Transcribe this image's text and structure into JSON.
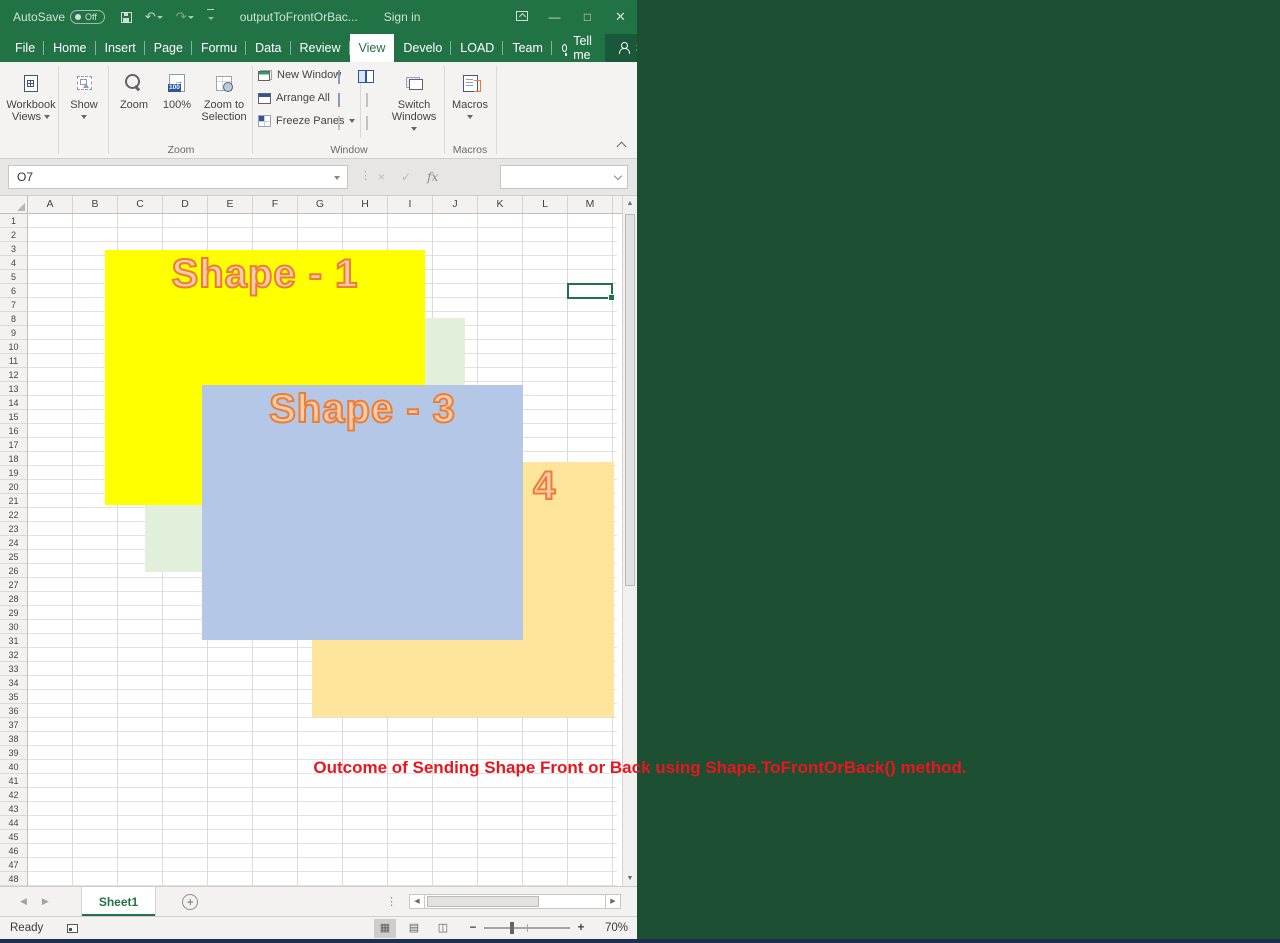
{
  "colors": {
    "titlebar_green": "#217346",
    "share_button_green": "#19583a",
    "window_divider_green": "#1d4f33",
    "bottom_strip_navy": "#1b2f52",
    "annotation_red": "#e8161e",
    "shape_text_fill": "#f8cbad",
    "shape_text_outline": "#ed7d31",
    "selection_green": "#217346"
  },
  "titlebar": {
    "autosave_label": "AutoSave",
    "autosave_state": "Off",
    "sign_in": "Sign in"
  },
  "ribbon_tabs": [
    {
      "label": "File"
    },
    {
      "label": "Home"
    },
    {
      "label": "Insert"
    },
    {
      "label": "Page L"
    },
    {
      "label": "Formu"
    },
    {
      "label": "Data"
    },
    {
      "label": "Review"
    },
    {
      "label": "View",
      "active": true
    },
    {
      "label": "Develo"
    },
    {
      "label": "LOAD T"
    },
    {
      "label": "Team"
    }
  ],
  "tellme_label": "Tell me",
  "share_label": "Share",
  "ribbon": {
    "workbook_views_line1": "Workbook",
    "workbook_views_line2": "Views",
    "show_label": "Show",
    "zoom_label": "Zoom",
    "hundred_label": "100%",
    "zoom_to_selection_line1": "Zoom to",
    "zoom_to_selection_line2": "Selection",
    "new_window_label": "New Window",
    "arrange_all_label": "Arrange All",
    "freeze_panes_label": "Freeze Panes",
    "switch_windows_line1": "Switch",
    "switch_windows_line2": "Windows",
    "macros_label": "Macros",
    "group_zoom": "Zoom",
    "group_window": "Window",
    "group_macros": "Macros"
  },
  "formula_bar": {
    "cancel": "×",
    "enter": "✓",
    "fx": "fx",
    "value": ""
  },
  "grid": {
    "columns": [
      "A",
      "B",
      "C",
      "D",
      "E",
      "F",
      "G",
      "H",
      "I",
      "J",
      "K",
      "L",
      "M"
    ],
    "rows": [
      "1",
      "2",
      "3",
      "4",
      "5",
      "6",
      "7",
      "8",
      "9",
      "10",
      "11",
      "12",
      "13",
      "14",
      "15",
      "16",
      "17",
      "18",
      "19",
      "20",
      "21",
      "22",
      "23",
      "24",
      "25",
      "26",
      "27",
      "28",
      "29",
      "30",
      "31",
      "32",
      "33",
      "34",
      "35",
      "36",
      "37",
      "38",
      "39",
      "40",
      "41",
      "42",
      "43",
      "44",
      "45",
      "46",
      "47",
      "48"
    ]
  },
  "windows": [
    {
      "title": "sampleToFrontOrBa...",
      "name_box": "M6",
      "is_active": true,
      "selected_col": "M",
      "selected_row": "6",
      "cursor_row": "37",
      "show_selection_cell": true,
      "shapes": [
        {
          "label": "Shape - 1",
          "fill": "#ffff00",
          "x": 77,
          "y": 36,
          "w": 320,
          "h": 255
        },
        {
          "label": "Shape - 2",
          "fill": "#e2efda",
          "x": 117,
          "y": 104,
          "w": 320,
          "h": 254
        },
        {
          "label": "Shape - 3",
          "fill": "#b4c7e7",
          "x": 174,
          "y": 171,
          "w": 321,
          "h": 255
        },
        {
          "label": "Shape - 4",
          "fill": "#ffe49c",
          "x": 284,
          "y": 248,
          "w": 302,
          "h": 255
        }
      ]
    },
    {
      "title": "outputToFrontOrBac...",
      "name_box": "O7",
      "is_active": false,
      "show_selection_cell": false,
      "shapes": [
        {
          "label": "Shape - 2",
          "fill": "#e2efda",
          "x": 117,
          "y": 104,
          "w": 320,
          "h": 254
        },
        {
          "label": "Shape - 4",
          "fill": "#ffe49c",
          "x": 284,
          "y": 248,
          "w": 302,
          "h": 255
        },
        {
          "label": "Shape - 1",
          "fill": "#ffff00",
          "x": 77,
          "y": 36,
          "w": 320,
          "h": 255
        },
        {
          "label": "Shape - 3",
          "fill": "#b4c7e7",
          "x": 174,
          "y": 171,
          "w": 321,
          "h": 255
        }
      ]
    }
  ],
  "sheet_bar": {
    "sheet_tab": "Sheet1",
    "add_sheet": "+"
  },
  "status_bar": {
    "ready": "Ready",
    "zoom_minus": "−",
    "zoom_plus": "+",
    "zoom_pct": "70%"
  },
  "annotation": {
    "text": "Outcome of Sending Shape Front or Back using Shape.ToFrontOrBack() method."
  }
}
